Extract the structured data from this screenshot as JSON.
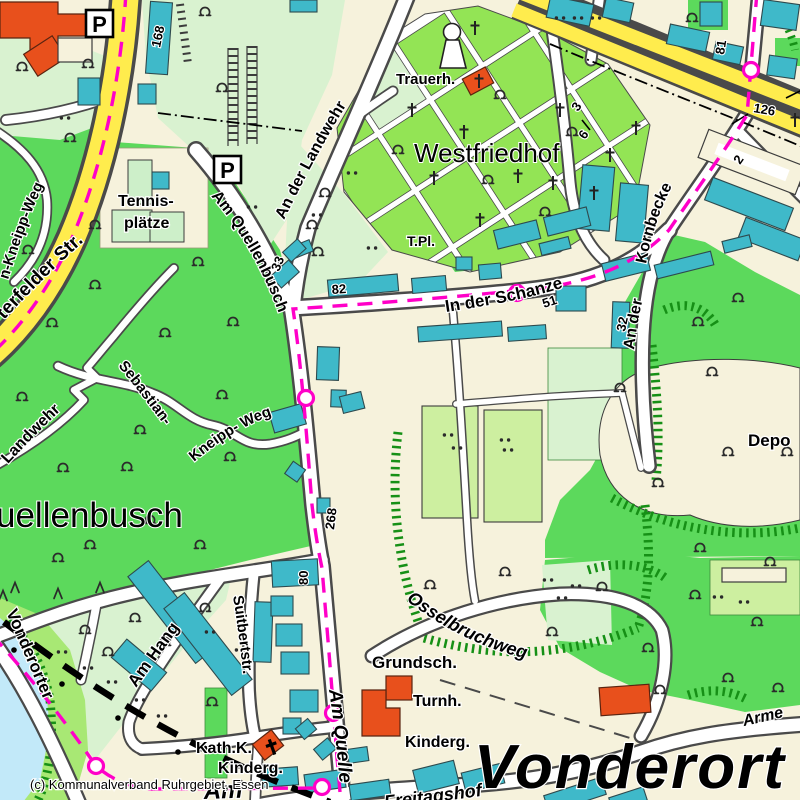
{
  "map": {
    "attribution": "(c) Kommunalverband Ruhrgebiet, Essen",
    "place_labels": {
      "westfriedhof": "Westfriedhof",
      "quellenbusch": "uellenbusch",
      "vonderort": "Vonderort",
      "deponie": "Depo"
    },
    "street_labels": {
      "an_der_landwehr": "An der Landwehr",
      "am_quellenbusch": "Am Quellenbusch",
      "in_der_schanze": "In der Schanze",
      "an_der": "An der",
      "kornbecke": "Kornbecke",
      "osterfelder_str": "terfelder  Str.",
      "kneipp_weg_nw": "n-Kneipp-Weg",
      "sebastian": "Sebastian-",
      "kneipp_weg": "Kneipp- Weg",
      "landwehr": "Landwehr",
      "osselbruchweg": "Osselbruchweg",
      "vonderorter": "Vonderorter",
      "am_hang": "Am Hang",
      "suitbertstr": "Suitbertstr.",
      "am_quelle": "Am Quelle",
      "am": "Am",
      "freitagshof": "Freitagshof",
      "arme": "Arme"
    },
    "poi_labels": {
      "trauerhalle": "Trauerh.",
      "tpl": "T.Pl.",
      "tennis_line1": "Tennis-",
      "tennis_line2": "plätze",
      "grundschule": "Grundsch.",
      "turnhalle": "Turnh.",
      "kindergarten": "Kinderg.",
      "kath_kirche": "Kath.K.",
      "kindergarten2": "Kinderg.",
      "parking": "P"
    },
    "numbers": {
      "route_268": "268",
      "n168": "168",
      "n81": "81",
      "n126": "126",
      "n3": "3",
      "n6": "6",
      "n2": "2",
      "n33": "33",
      "n82": "82",
      "n51": "51",
      "n32": "32",
      "n80": "80"
    },
    "colors": {
      "urban": "#F6F2DC",
      "forest": "#5CD95C",
      "meadow": "#D9F2D0",
      "cemetery": "#93E455",
      "orchard": "#A8E874",
      "allotment": "#CDEFA0",
      "building": "#3FB9C9",
      "public_building": "#E8501C",
      "major_road": "#FFEC4D",
      "road_casing": "#4A4A4A",
      "route": "#FF00C8",
      "water": "#C2E9F9"
    }
  }
}
